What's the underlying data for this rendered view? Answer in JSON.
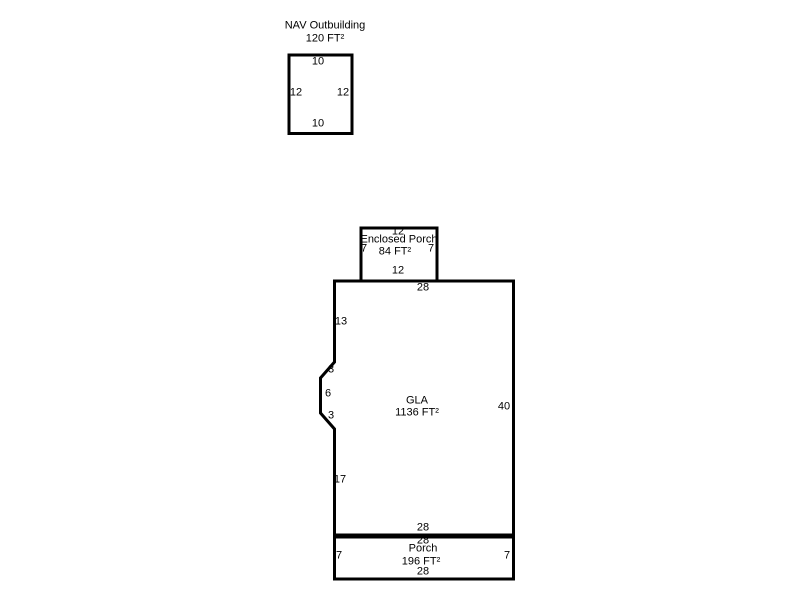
{
  "sketch": {
    "background_color": "#ffffff",
    "line_color": "#000000",
    "text_color": "#000000",
    "outbuilding": {
      "label": "NAV Outbuilding",
      "area": "120 FT²",
      "dims": {
        "top": "10",
        "left": "12",
        "right": "12",
        "bottom": "10"
      }
    },
    "enclosed_porch": {
      "label": "Enclosed Porch",
      "area": "84 FT²",
      "dims": {
        "top": "12",
        "left": "7",
        "right": "7",
        "bottom": "12"
      }
    },
    "gla": {
      "label": "GLA",
      "area": "1136 FT²",
      "dims": {
        "top": "28",
        "left_upper": "13",
        "bay_upper": "3",
        "bay_left": "6",
        "bay_lower": "3",
        "left_lower": "17",
        "right": "40",
        "bottom": "28"
      }
    },
    "porch": {
      "label": "Porch",
      "area": "196 FT²",
      "dims": {
        "top": "28",
        "left": "7",
        "right": "7",
        "bottom": "28"
      }
    }
  }
}
